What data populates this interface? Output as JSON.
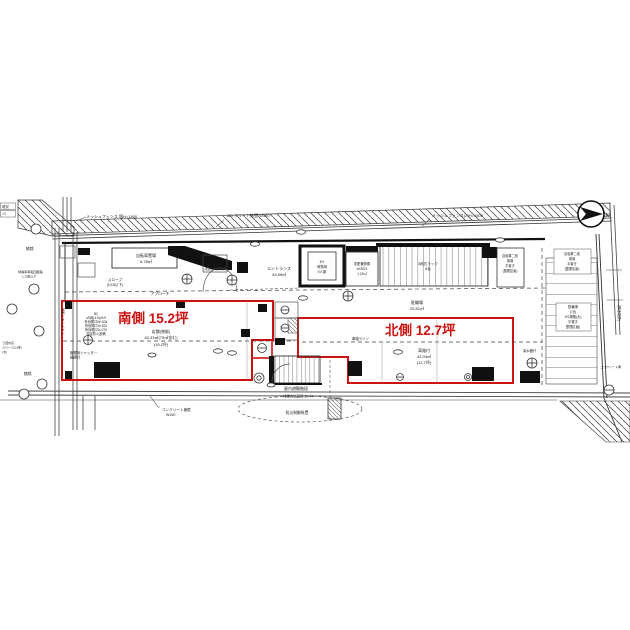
{
  "north_arrow": {
    "label": "N"
  },
  "zones": {
    "south": {
      "title": "南側  15.2坪",
      "use": "店舗(物販)",
      "area": "63.33㎡(75㎡含む)",
      "tsubo": "(19.2坪)"
    },
    "north": {
      "title": "北側  12.7坪",
      "use": "車路付",
      "area": "42.04㎡",
      "tsubo": "(12.7坪)"
    }
  },
  "rooms": {
    "bicycle": {
      "name": "自転車置場",
      "area": "6.78㎡"
    },
    "entrance": {
      "name": "エントランス",
      "area": "33.89㎡"
    },
    "ev": {
      "line1": "EV",
      "line2": "荷物用",
      "line3": "9人乗"
    },
    "storage": {
      "line1": "宅配兼物置",
      "line2": "W.BOX",
      "line3": "1.26㎡"
    },
    "rack": {
      "line1": "3段式ラック",
      "line2": "5台"
    },
    "bike_parking": {
      "name": "駐輪場",
      "area": "25.81㎡"
    },
    "outdoor_bike": [
      "自転車二段",
      "置場",
      "平置き",
      "(整理区画)"
    ],
    "parking7": [
      "駐輪場",
      "(7台",
      "JIS規格(大)",
      "平置き",
      "整理区画)"
    ],
    "awning": [
      "オーニング",
      "(宅配)ボックス"
    ],
    "stair": {
      "name": "屋内避難階段"
    }
  },
  "notes": {
    "mesh_fence_left": "メッシュフェンス 塀H=1800",
    "concrete_wall_top": "コンクリート擁壁 W150",
    "mesh_fence_right": "メッシュフェンス(2)H=1800",
    "slope1": "スロープ",
    "slope2": "(1/15以下)",
    "approach": "アプローチ",
    "car_line": "車路ライン",
    "shutter1": "管理用シャッター",
    "shutter2": "袖扉付",
    "spec": [
      "B2",
      "U5用(4.5)±5.9",
      "有効開口W=534",
      "有効開口H=531",
      "有効開口D=270",
      "特定防火設備"
    ],
    "smoke": "排煙有効面積 35.44",
    "disaster": "防災制御装置",
    "concrete_wall_bottom1": "コンクリート擁壁",
    "concrete_wall_bottom2": "W150",
    "meter": "量水器付",
    "planting_top": "植栽",
    "planting_bottom": "植栽",
    "turn1": "特殊車両転回経路",
    "turn2": "1.7t車以下",
    "space1": "う回対応",
    "space2": "スペース(2t車)",
    "space3": "2台",
    "road_left": "アスファルト舗装",
    "neighbor_right": "(隣地境界)",
    "fence_right1": "コンクリート塀",
    "corner1": "現況",
    "corner2": "+2"
  }
}
